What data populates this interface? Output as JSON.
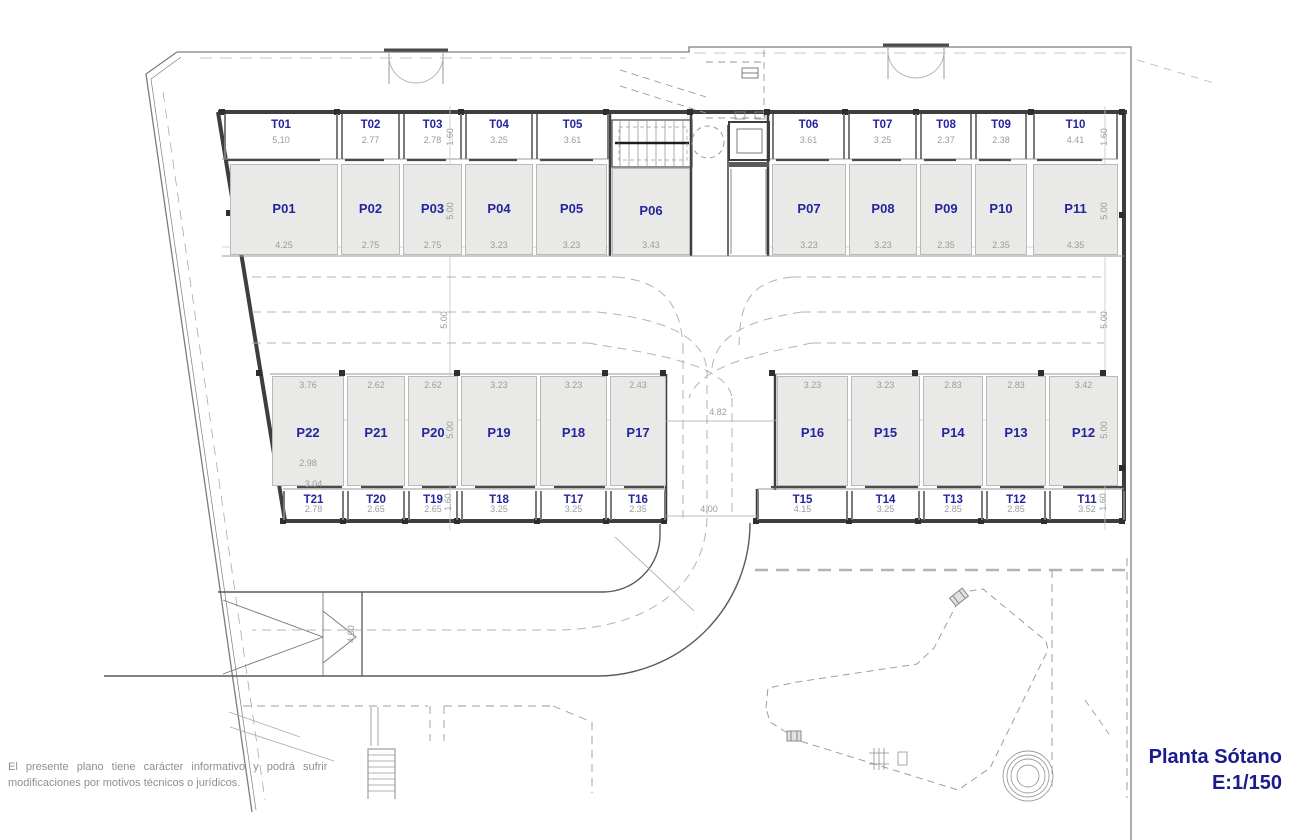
{
  "title": {
    "name": "Planta Sótano",
    "scale": "E:1/150"
  },
  "disclaimer": {
    "line1": "El presente plano tiene carácter informativo y podrá sufrir",
    "line2": "modificaciones por motivos técnicos o jurídicos."
  },
  "colors": {
    "label_navy": "#2424a0",
    "dim_gray": "#9b9b9b",
    "cell_fill": "#e9e9e7",
    "wall": "#3e3e3e"
  },
  "dims": {
    "t_row_height": "1.60",
    "p_row_height": "5.00",
    "aisle_width": "5.00",
    "drive_width": "4.82",
    "drive_clear": "4.00",
    "ramp_width": "4.00"
  },
  "plan": {
    "top_left": {
      "trasteros": [
        {
          "label": "T01",
          "dim": "5.10"
        },
        {
          "label": "T02",
          "dim": "2.77"
        },
        {
          "label": "T03",
          "dim": "2.78"
        },
        {
          "label": "T04",
          "dim": "3.25"
        },
        {
          "label": "T05",
          "dim": "3.61"
        }
      ],
      "parkings": [
        {
          "label": "P01",
          "dim": "4.25"
        },
        {
          "label": "P02",
          "dim": "2.75"
        },
        {
          "label": "P03",
          "dim": "2.75"
        },
        {
          "label": "P04",
          "dim": "3.23"
        },
        {
          "label": "P05",
          "dim": "3.23"
        }
      ]
    },
    "top_center": {
      "parkings": [
        {
          "label": "P06",
          "dim": "3.43"
        }
      ]
    },
    "top_right": {
      "trasteros": [
        {
          "label": "T06",
          "dim": "3.61"
        },
        {
          "label": "T07",
          "dim": "3.25"
        },
        {
          "label": "T08",
          "dim": "2.37"
        },
        {
          "label": "T09",
          "dim": "2.38"
        },
        {
          "label": "T10",
          "dim": "4.41"
        }
      ],
      "parkings": [
        {
          "label": "P07",
          "dim": "3.23"
        },
        {
          "label": "P08",
          "dim": "3.23"
        },
        {
          "label": "P09",
          "dim": "2.35"
        },
        {
          "label": "P10",
          "dim": "2.35"
        },
        {
          "label": "P11",
          "dim": "4.35"
        }
      ]
    },
    "bottom_left": {
      "parkings": [
        {
          "label": "P22",
          "dim": "3.76",
          "dim2": "2.98"
        },
        {
          "label": "P21",
          "dim": "2.62"
        },
        {
          "label": "P20",
          "dim": "2.62"
        },
        {
          "label": "P19",
          "dim": "3.23"
        },
        {
          "label": "P18",
          "dim": "3.23"
        },
        {
          "label": "P17",
          "dim": "2.43"
        }
      ],
      "trasteros": [
        {
          "label": "T21",
          "dim": "2.78",
          "dim2": "3.04"
        },
        {
          "label": "T20",
          "dim": "2.65"
        },
        {
          "label": "T19",
          "dim": "2.65"
        },
        {
          "label": "T18",
          "dim": "3.25"
        },
        {
          "label": "T17",
          "dim": "3.25"
        },
        {
          "label": "T16",
          "dim": "2.35"
        }
      ]
    },
    "bottom_right": {
      "parkings": [
        {
          "label": "P16",
          "dim": "3.23"
        },
        {
          "label": "P15",
          "dim": "3.23"
        },
        {
          "label": "P14",
          "dim": "2.83"
        },
        {
          "label": "P13",
          "dim": "2.83"
        },
        {
          "label": "P12",
          "dim": "3.42"
        }
      ],
      "trasteros": [
        {
          "label": "T15",
          "dim": "4.15"
        },
        {
          "label": "T14",
          "dim": "3.25"
        },
        {
          "label": "T13",
          "dim": "2.85"
        },
        {
          "label": "T12",
          "dim": "2.85"
        },
        {
          "label": "T11",
          "dim": "3.52"
        }
      ]
    }
  }
}
